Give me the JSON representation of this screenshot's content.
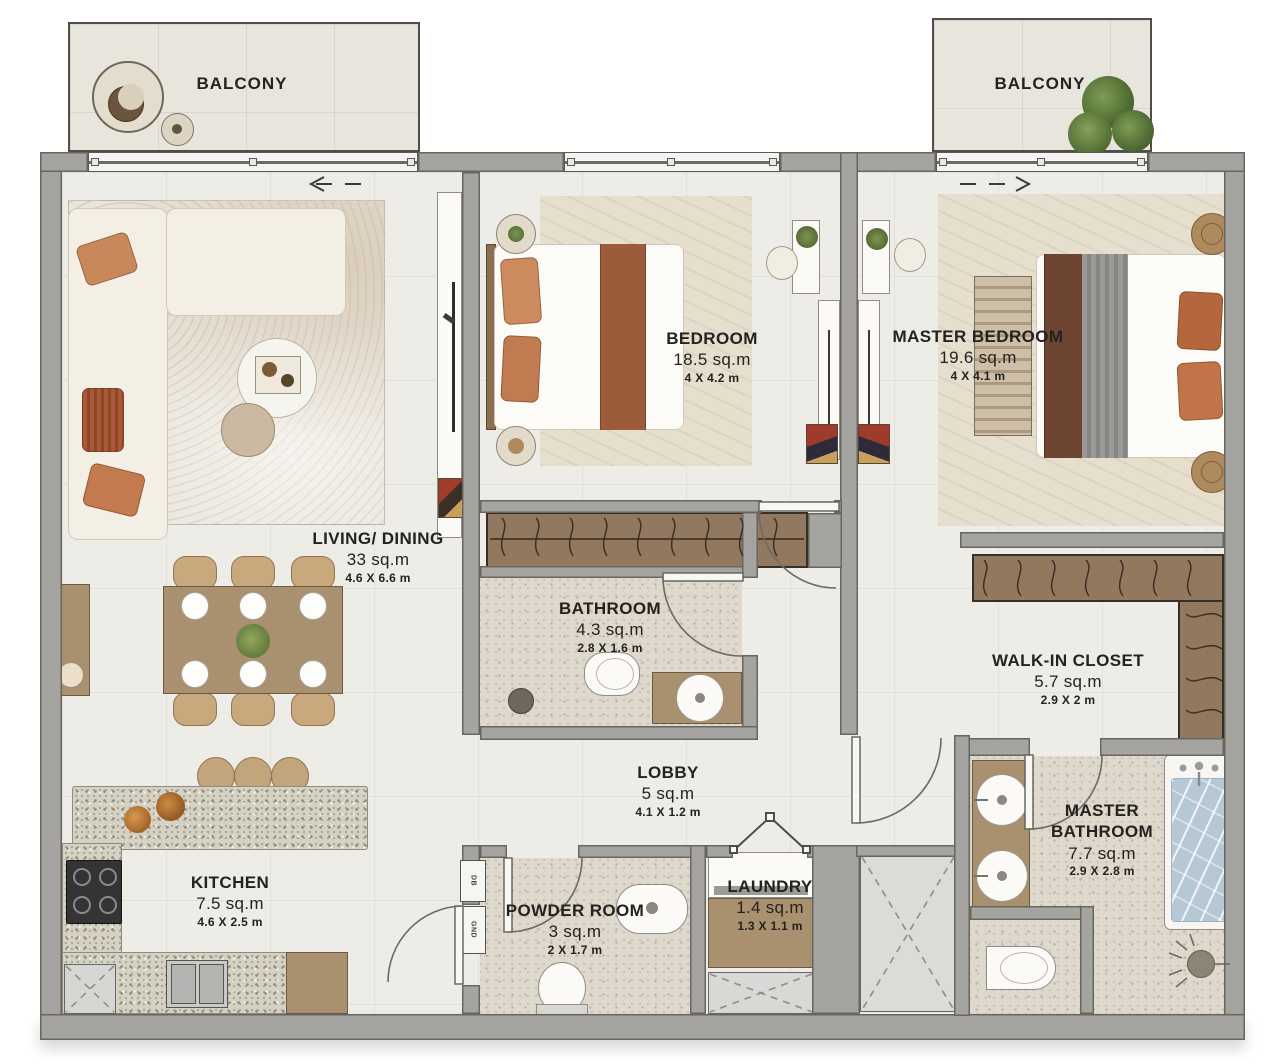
{
  "balconies": {
    "left": "BALCONY",
    "right": "BALCONY"
  },
  "rooms": {
    "living": {
      "name": "LIVING/ DINING",
      "area": "33 sq.m",
      "dims": "4.6 X 6.6 m"
    },
    "bedroom": {
      "name": "BEDROOM",
      "area": "18.5 sq.m",
      "dims": "4 X 4.2 m"
    },
    "master": {
      "name": "MASTER BEDROOM",
      "area": "19.6 sq.m",
      "dims": "4 X 4.1 m"
    },
    "bathroom": {
      "name": "BATHROOM",
      "area": "4.3 sq.m",
      "dims": "2.8 X 1.6 m"
    },
    "walkin": {
      "name": "WALK-IN CLOSET",
      "area": "5.7 sq.m",
      "dims": "2.9 X 2 m"
    },
    "lobby": {
      "name": "LOBBY",
      "area": "5 sq.m",
      "dims": "4.1 X 1.2 m"
    },
    "masterbath": {
      "name": "MASTER BATHROOM",
      "area": "7.7 sq.m",
      "dims": "2.9 X 2.8 m"
    },
    "kitchen": {
      "name": "KITCHEN",
      "area": "7.5 sq.m",
      "dims": "4.6 X 2.5 m"
    },
    "powder": {
      "name": "POWDER ROOM",
      "area": "3 sq.m",
      "dims": "2 X 1.7 m"
    },
    "laundry": {
      "name": "LAUNDRY",
      "area": "1.4 sq.m",
      "dims": "1.3 X 1.1 m"
    }
  },
  "panels": {
    "db": "DB",
    "gnd": "GND"
  },
  "colors": {
    "wall": "#a6a4a1",
    "floor": "#edece6",
    "terrazzo": "#ded8cd",
    "wood": "#a9906f",
    "terracotta": "#c9885c",
    "water": "#b5c8d4",
    "plant": "#5f8140"
  }
}
